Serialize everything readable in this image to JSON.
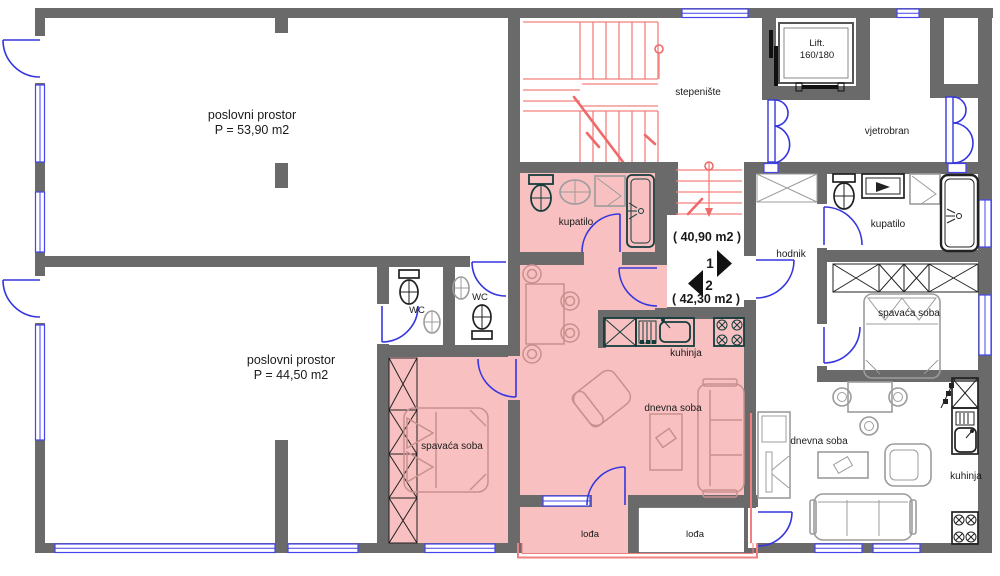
{
  "plan_title": "floor plan",
  "rooms": {
    "business_top": {
      "name": "poslovni prostor",
      "area": "P = 53,90 m2"
    },
    "business_bottom": {
      "name": "poslovni prostor",
      "area": "P = 44,50 m2"
    },
    "staircase": {
      "name": "stepenište"
    },
    "lift": {
      "name": "Lift.",
      "dimensions": "160/180"
    },
    "vestibule": {
      "name": "vjetrobran"
    },
    "hallway": {
      "name": "hodnik"
    },
    "bathroom_apt1": {
      "name": "kupatilo"
    },
    "bathroom_apt2": {
      "name": "kupatilo"
    },
    "wc_left": {
      "name": "WC"
    },
    "wc_right": {
      "name": "WC"
    },
    "bedroom_apt1": {
      "name": "spavaća soba"
    },
    "bedroom_apt2": {
      "name": "spavaća soba"
    },
    "kitchen_apt1": {
      "name": "kuhinja"
    },
    "kitchen_apt2": {
      "name": "kuhinja"
    },
    "living_apt1": {
      "name": "dnevna soba"
    },
    "living_apt2": {
      "name": "dnevna soba"
    },
    "loggia_apt1": {
      "name": "lođa"
    },
    "loggia_apt2": {
      "name": "lođa"
    }
  },
  "apartments": {
    "apt1": {
      "number": "1",
      "area": "( 40,90 m2 )"
    },
    "apt2": {
      "number": "2",
      "area": "( 42,30 m2 )"
    }
  },
  "colors": {
    "wall_gray": "#6A6A6A",
    "apartment2_highlight_pink": "#F8C0C0",
    "stairs_red": "#F4807E",
    "openings_blue": "#3535E0",
    "fixtures_dark": "#143C3C"
  }
}
